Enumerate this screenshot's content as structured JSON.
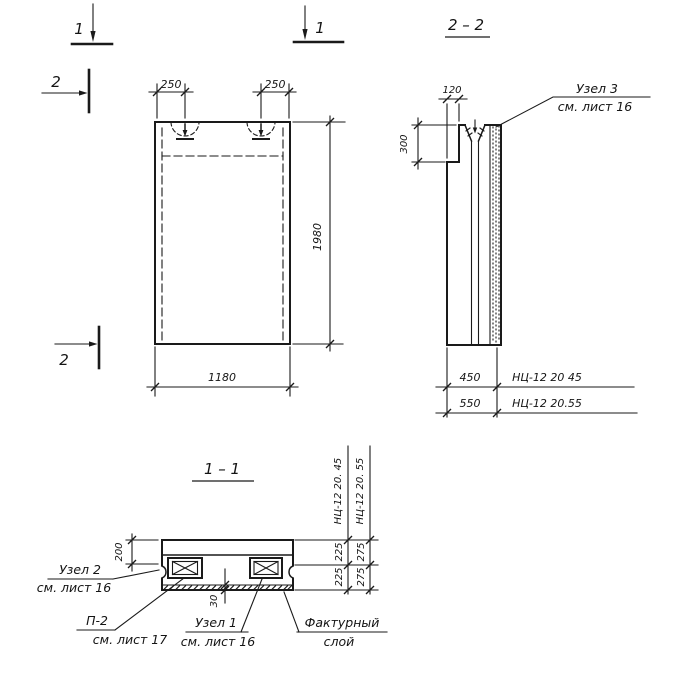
{
  "markers": {
    "sec1_left": "1",
    "sec1_right": "1",
    "sec2_top": "2",
    "sec2_bottom": "2"
  },
  "elevation": {
    "dim_left_loop": "250",
    "dim_right_loop": "250",
    "dim_width": "1180",
    "dim_height": "1980"
  },
  "section_2_2": {
    "title": "2 – 2",
    "dim_step": "120",
    "dim_step_height": "300",
    "node3": {
      "line1": "Узел 3",
      "line2": "см. лист 16"
    },
    "variants": [
      {
        "dim": "450",
        "mark": "НЦ-12 20 45"
      },
      {
        "dim": "550",
        "mark": "НЦ-12 20.55"
      }
    ]
  },
  "section_1_1": {
    "title": "1 – 1",
    "dim_top": "200",
    "dim_layer": "30",
    "columns": [
      {
        "header": "НЦ-12 20. 45",
        "top": "225",
        "bottom": "225"
      },
      {
        "header": "НЦ-12 20. 55",
        "top": "275",
        "bottom": "275"
      }
    ],
    "node2": {
      "line1": "Узел 2",
      "line2": "см. лист 16"
    },
    "p2": {
      "line1": "П-2",
      "line2": "см. лист 17"
    },
    "node1": {
      "line1": "Узел 1",
      "line2": "см. лист 16"
    },
    "facing": {
      "line1": "Фактурный",
      "line2": "слой"
    }
  }
}
